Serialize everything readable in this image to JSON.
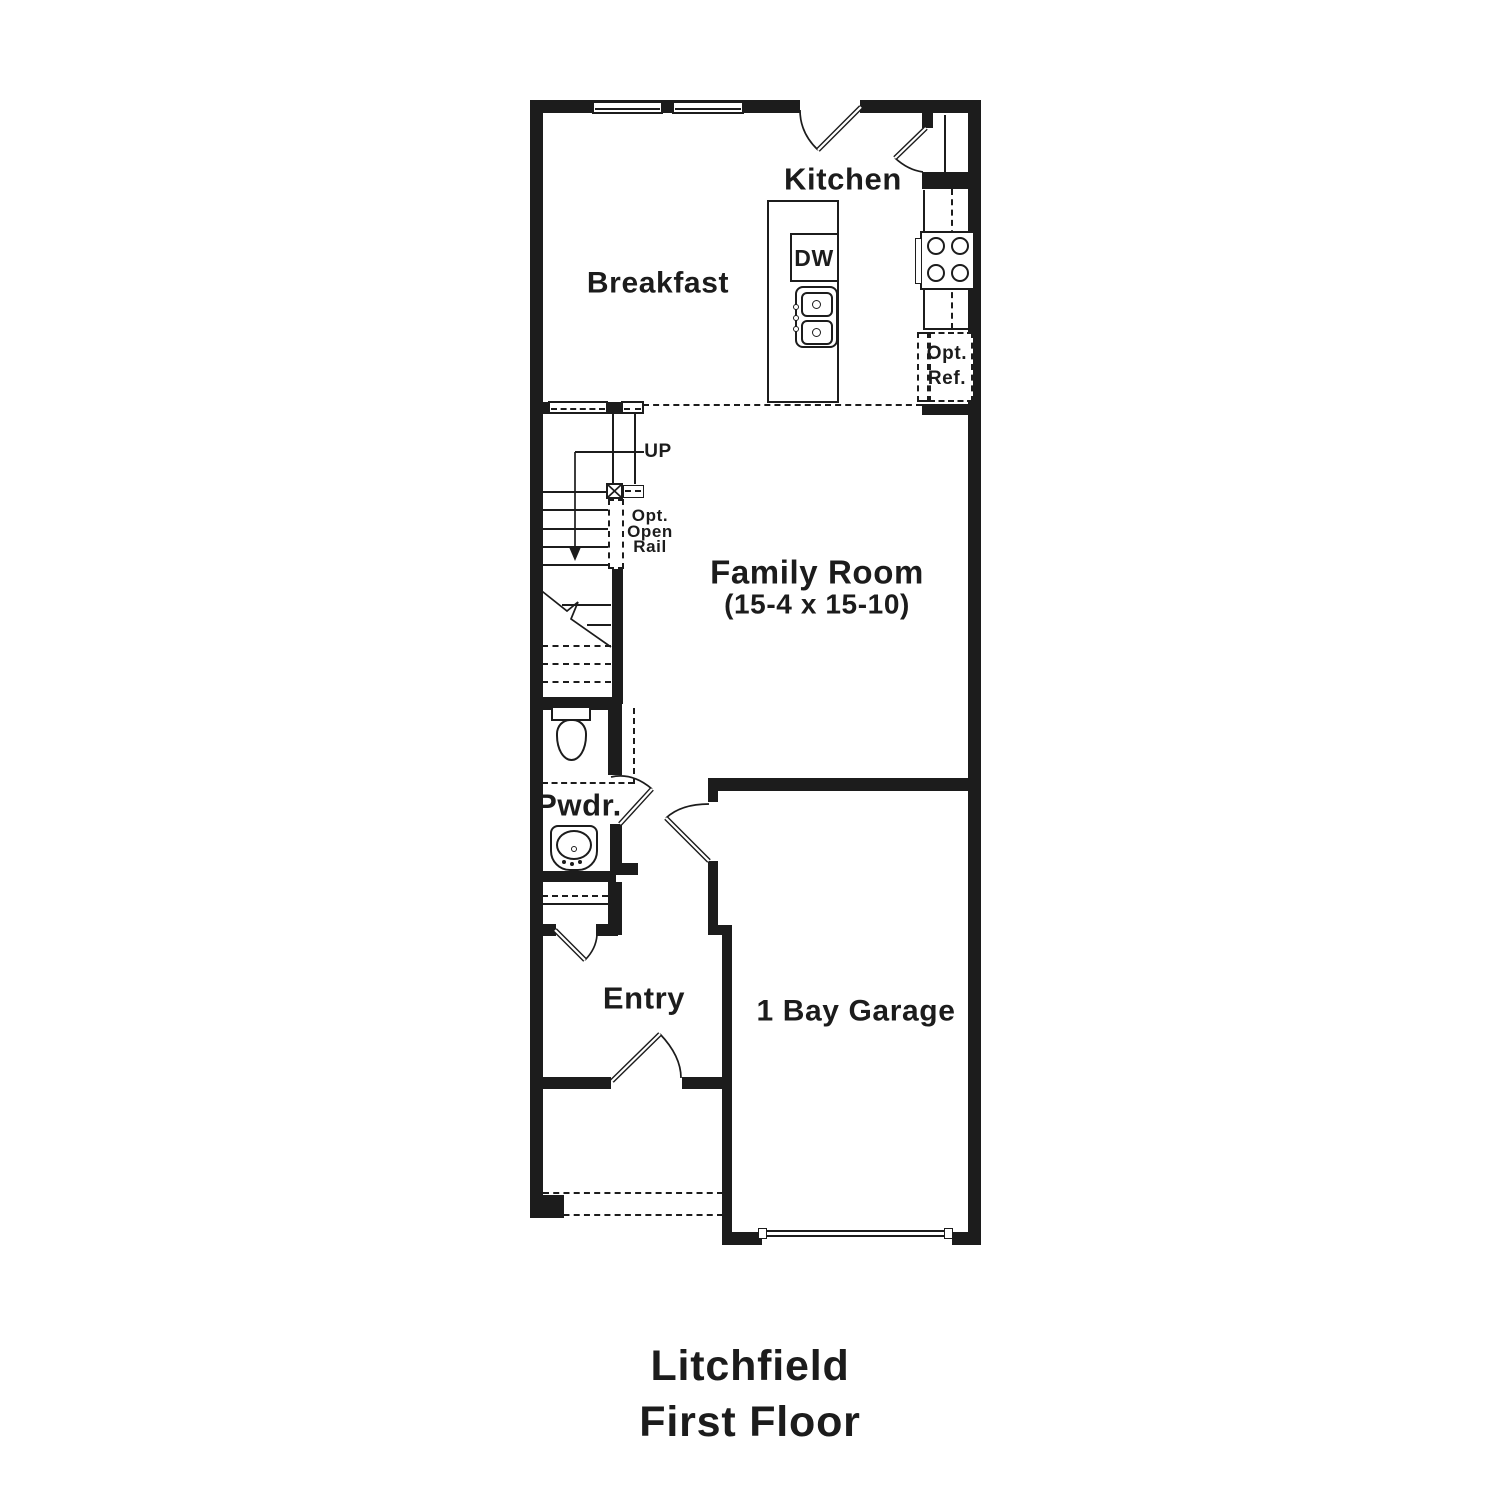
{
  "plan": {
    "rooms": {
      "kitchen": "Kitchen",
      "breakfast": "Breakfast",
      "family_room_name": "Family Room",
      "family_room_dims": "(15-4 x 15-10)",
      "powder": "Pwdr.",
      "entry": "Entry",
      "garage": "1 Bay Garage"
    },
    "fixtures": {
      "dishwasher": "DW",
      "opt_ref_line1": "Opt.",
      "opt_ref_line2": "Ref."
    },
    "stairs": {
      "up_label": "UP",
      "rail_line1": "Opt.",
      "rail_line2": "Open",
      "rail_line3": "Rail"
    }
  },
  "footer": {
    "plan_name": "Litchfield",
    "floor_name": "First Floor"
  },
  "colors": {
    "line": "#1c1c1c",
    "background": "#ffffff"
  }
}
